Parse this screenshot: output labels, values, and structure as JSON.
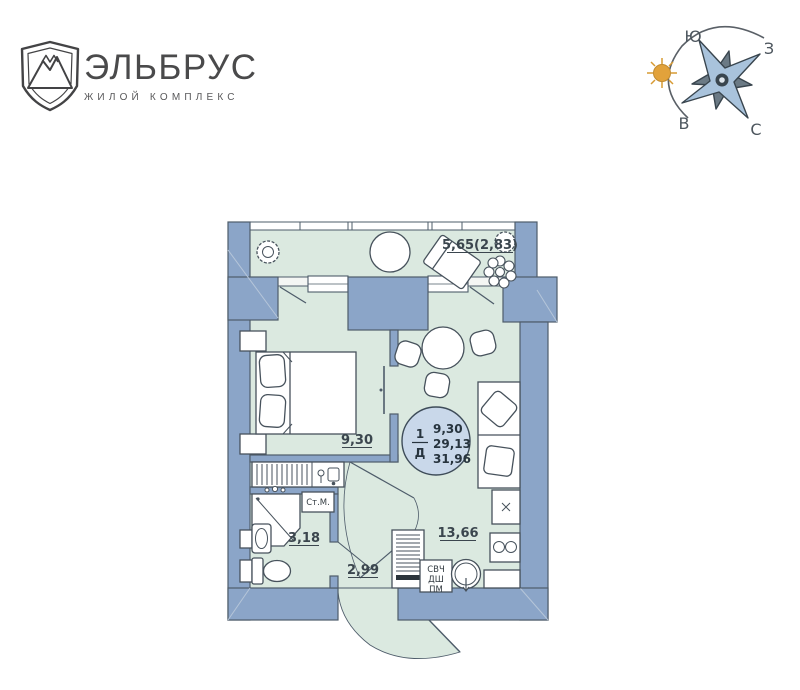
{
  "logo": {
    "title": "ЭЛЬБРУС",
    "subtitle": "ЖИЛОЙ КОМПЛЕКС"
  },
  "compass": {
    "south": "Ю",
    "west": "З",
    "east": "В",
    "north": "С"
  },
  "plan": {
    "rooms": {
      "balcony": {
        "label": "5,65(2,83)"
      },
      "bedroom": {
        "label": "9,30"
      },
      "living_kitchen": {
        "label": "13,66"
      },
      "bathroom": {
        "label": "3,18"
      },
      "hall": {
        "label": "2,99"
      }
    },
    "badge": {
      "type_number": "1",
      "type_letter": "Д",
      "lines": [
        "9,30",
        "29,13",
        "31,96"
      ]
    },
    "appliances": {
      "washing_machine": "Ст.М.",
      "lines": [
        "СВЧ",
        "ДШ",
        "ПМ"
      ]
    }
  },
  "colors": {
    "wall": "#8ba5c8",
    "outline": "#4e5c6a",
    "room": "#dbe9e0",
    "badge_fill": "#c9d8ea",
    "sun": "#e2a23b",
    "star_light": "#a9c3dc",
    "star_dark": "#6b7a85"
  }
}
